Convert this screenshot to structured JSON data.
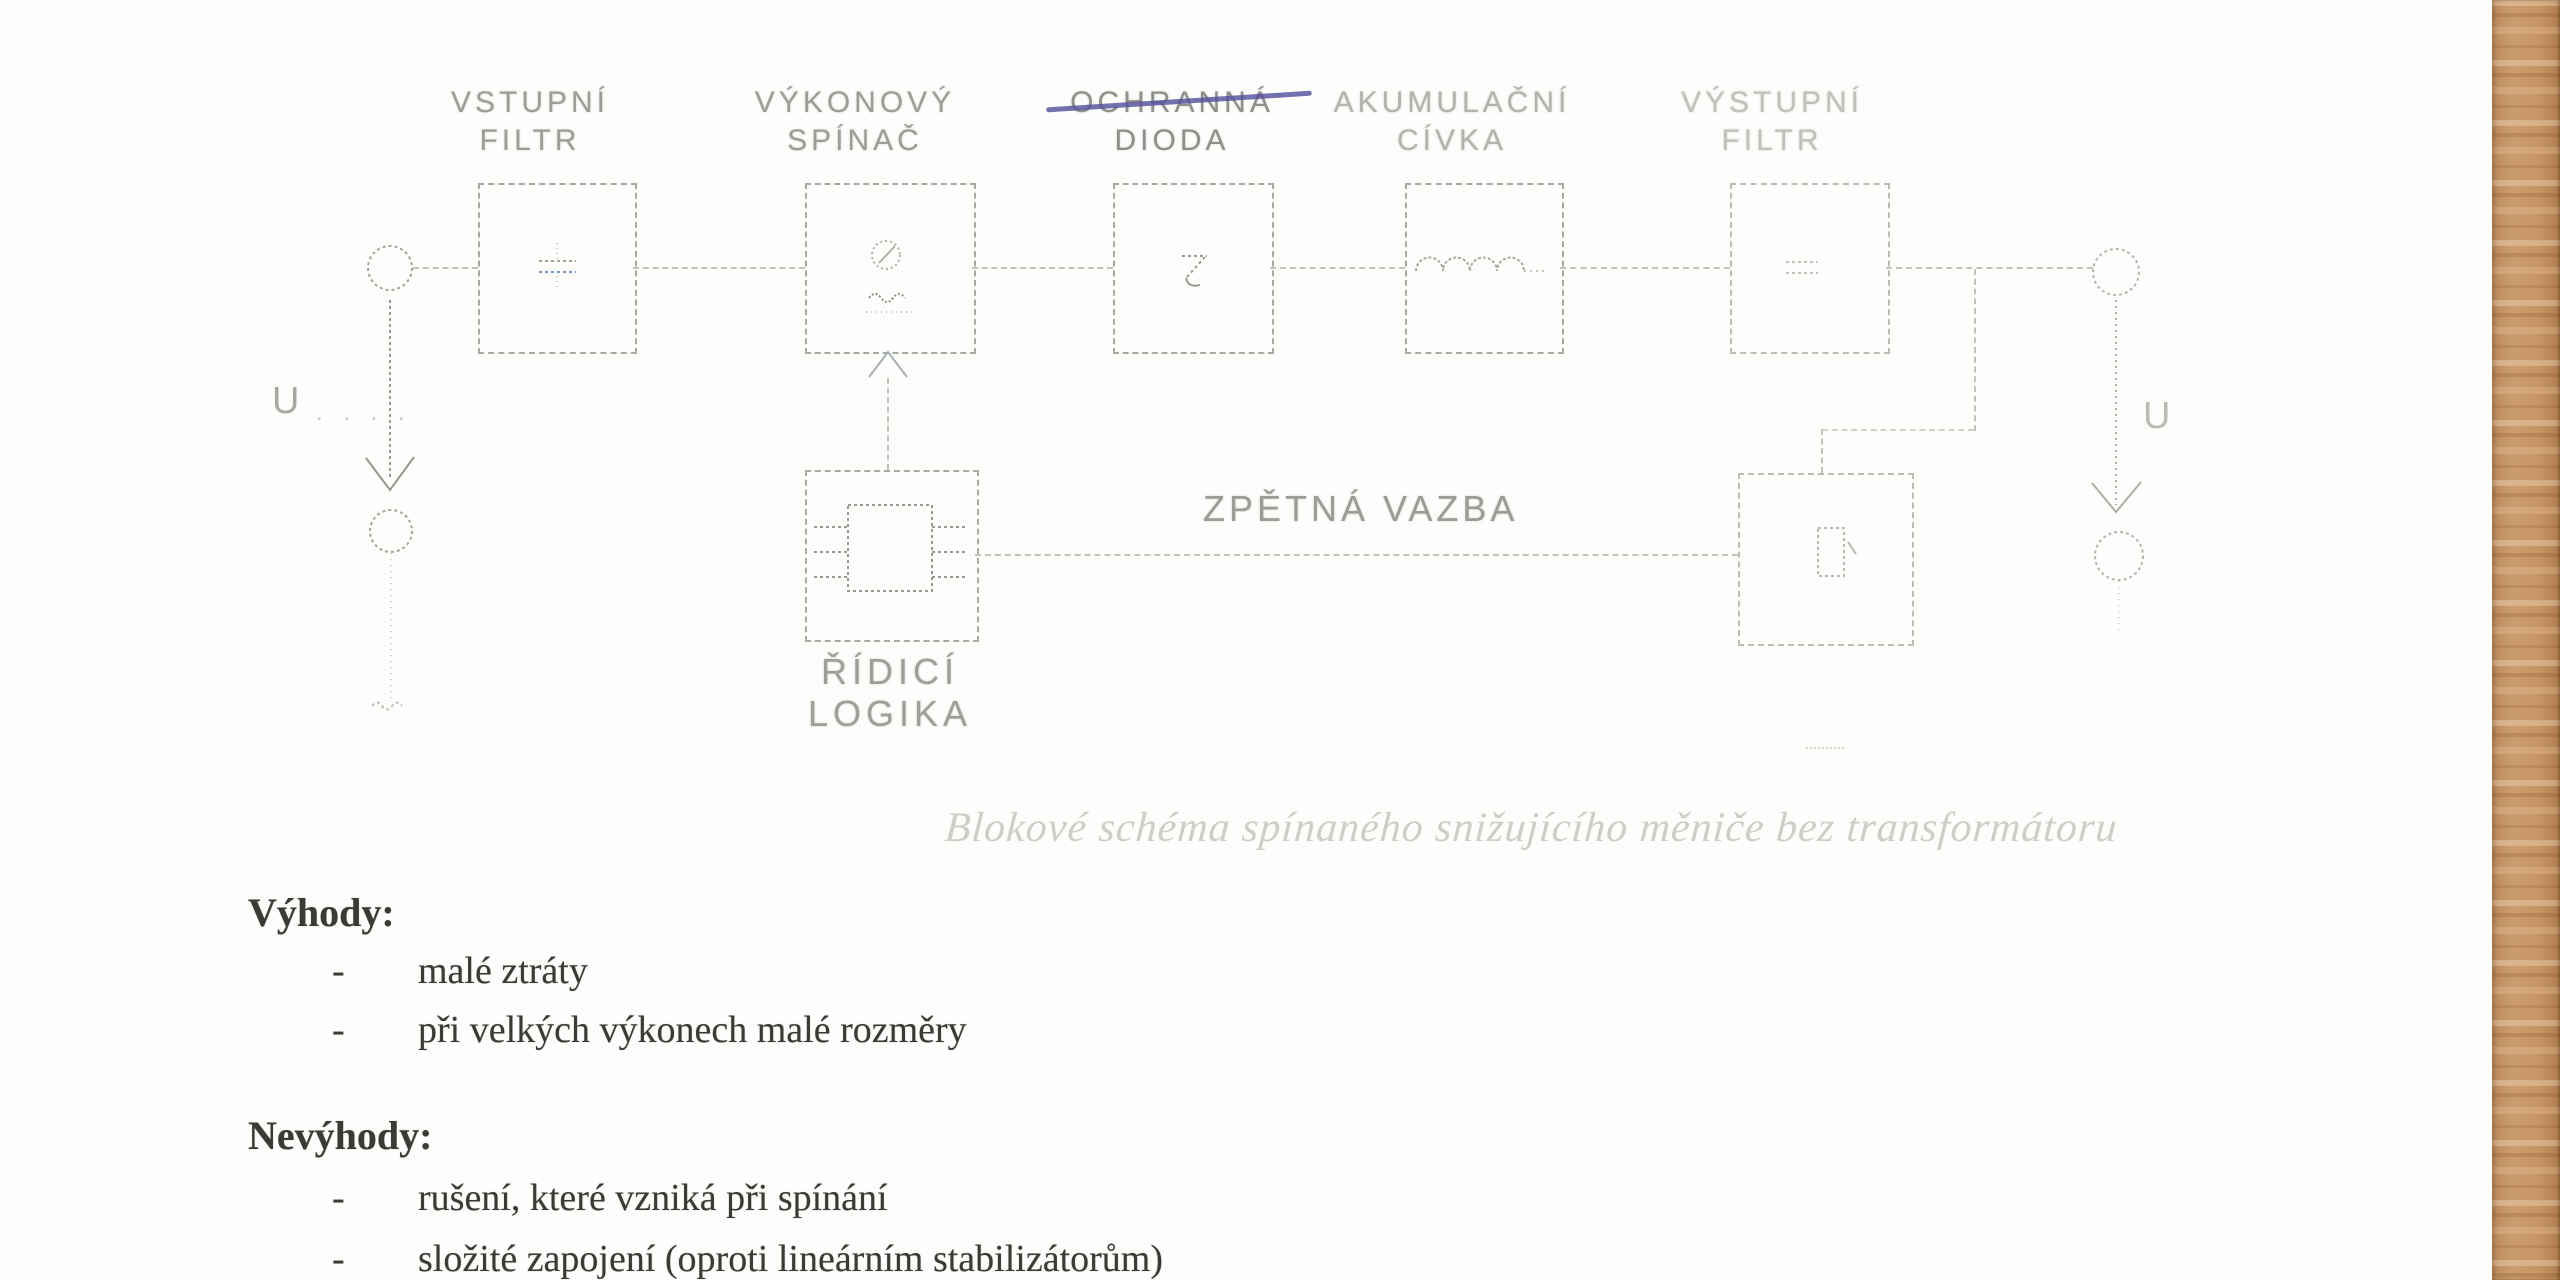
{
  "diagram": {
    "blocks": [
      {
        "line1": "VSTUPNÍ",
        "line2": "FILTR"
      },
      {
        "line1": "VÝKONOVÝ",
        "line2": "SPÍNAČ"
      },
      {
        "line1": "OCHRANNÁ",
        "line2": "DIODA",
        "struck_through": true
      },
      {
        "line1": "AKUMULAČNÍ",
        "line2": "CÍVKA"
      },
      {
        "line1": "VÝSTUPNÍ",
        "line2": "FILTR"
      }
    ],
    "control_block": {
      "line1": "ŘÍDICÍ",
      "line2": "LOGIKA"
    },
    "feedback_label": "ZPĚTNÁ VAZBA",
    "input_terminal_label": "U",
    "input_terminal_dots": ". . . .",
    "output_terminal_label": "U",
    "caption": "Blokové schéma spínaného snižujícího měniče bez transformátoru"
  },
  "notes": {
    "advantages_heading": "Výhody:",
    "advantages": [
      "malé ztráty",
      "při velkých výkonech malé rozměry"
    ],
    "disadvantages_heading": "Nevýhody:",
    "disadvantages": [
      "rušení, které vzniká při spínání",
      "složité zapojení (oproti lineárním stabilizátorům)"
    ],
    "bullet_char": "-"
  },
  "colors": {
    "pen_strike": "#54509c",
    "wood_base": "#c69468",
    "diagram_line": "#b5b5ac",
    "body_text": "#3b3a35"
  }
}
